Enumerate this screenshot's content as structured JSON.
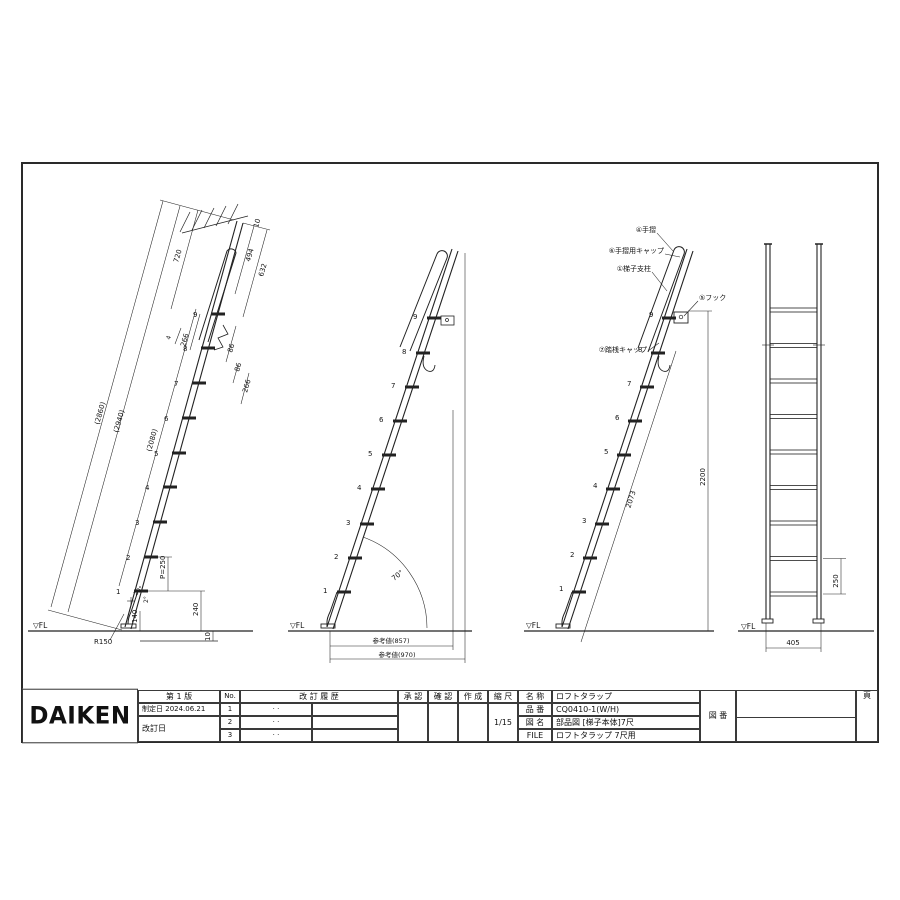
{
  "drawing": {
    "fl": "▽FL",
    "v1": {
      "rungs": [
        "1",
        "2",
        "3",
        "4",
        "5",
        "6",
        "7",
        "8",
        "9"
      ],
      "d2860": "(2860)",
      "d2940": "(2940)",
      "d2080": "(2080)",
      "d720": "720",
      "d494": "494",
      "d632": "632",
      "d10_top": "10",
      "d266_a": "266",
      "d86_a": "86",
      "d86_b": "86",
      "d266_b": "266",
      "p250": "P=250",
      "d240": "240",
      "d140": "140",
      "d10_floor": "10",
      "r150": "R150",
      "a2": "2°",
      "a20": "20°",
      "weld": "4"
    },
    "v2": {
      "rungs": [
        "1",
        "2",
        "3",
        "4",
        "5",
        "6",
        "7",
        "8",
        "9"
      ],
      "angle": "70°",
      "ref857": "参考値(857)",
      "ref970": "参考値(970)"
    },
    "v3": {
      "rungs": [
        "1",
        "2",
        "3",
        "4",
        "5",
        "6",
        "7",
        "8",
        "9"
      ],
      "part_handrail": "④手摺",
      "part_handrail_cap": "⑥手摺用キャップ",
      "part_post": "①梯子支柱",
      "part_hook": "⑤フック",
      "part_rung_cap": "⑦踏桟キャップ",
      "d2073": "2073",
      "d2200": "2200"
    },
    "v4": {
      "d250": "250",
      "d405": "405"
    }
  },
  "title_block": {
    "logo": "DAIKEN",
    "edition": "第 1 版",
    "enacted_label": "制定日",
    "enacted_date": "2024.06.21",
    "revised_label": "改訂日",
    "no_label": "No.",
    "revision_history_label": "改 訂 履 歴",
    "rev_rows": [
      {
        "no": "1",
        "dots": "·    ·"
      },
      {
        "no": "2",
        "dots": "·    ·"
      },
      {
        "no": "3",
        "dots": "·    ·"
      }
    ],
    "approval_label": "承 認",
    "confirm_label": "確 認",
    "create_label": "作 成",
    "scale_label": "縮 尺",
    "scale_value": "1/15",
    "name_label": "名 称",
    "name_value": "ロフトタラップ",
    "part_no_label": "品 番",
    "part_no_value": "CQ0410-1(W/H)",
    "drawing_name_label": "図 名",
    "drawing_name_value": "部品図 [梯子本体]7尺",
    "file_label": "FILE",
    "file_value": "ロフトタラップ 7尺用",
    "drawing_no_label": "図 番",
    "page_label": "頁"
  }
}
